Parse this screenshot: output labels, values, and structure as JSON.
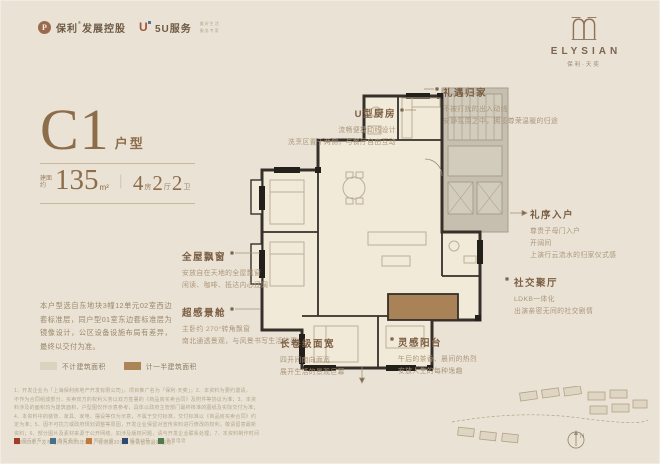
{
  "header": {
    "poly_brand": "保利",
    "poly_reg": "®",
    "poly_suffix": "发展控股",
    "service_brand": "5U服务",
    "service_note_1": "美好生活",
    "service_note_2": "服务专家",
    "project_name": "ELYSIAN",
    "project_sub": "保利·天奕"
  },
  "hero": {
    "code": "C1",
    "code_suffix": "户型",
    "area_label": "建面约",
    "area_value": "135",
    "area_unit": "m²",
    "divider": "｜",
    "room_1_num": "4",
    "room_1_unit": "房",
    "room_2_num": "2",
    "room_2_unit": "厅",
    "room_3_num": "2",
    "room_3_unit": "卫"
  },
  "annotations": {
    "u_kitchen": {
      "title": "U型厨房",
      "line1": "流畅便捷动线设计",
      "line2": "洗烹区置于两侧，与餐厅自由互动"
    },
    "homecoming": {
      "title": "礼遇归家",
      "line1": "不被打扰的出入动线",
      "line2": "安静氛围之中，拥揽尊荣温暖的归途"
    },
    "entry": {
      "title": "礼序入户",
      "line1": "尊贵子母门入户",
      "line2": "开阔间",
      "line3": "上演行云流水的归家仪式感"
    },
    "social": {
      "title": "社交聚厅",
      "line1": "LDKB一体化",
      "line2": "出演亲密无间的社交剧情"
    },
    "bay": {
      "title": "全屋飘窗",
      "line1": "安放自在天地的全屋飘窗",
      "line2": "闲读、咖啡、抵达内心辽阔"
    },
    "view": {
      "title": "超感景舱",
      "line1": "主卧约 270°转角飘窗",
      "line2": "南北通透景观，与风景书写生活故事"
    },
    "width": {
      "title": "长卷级面宽",
      "line1": "四开间南向面宽",
      "line2": "展开生活的景观巨幕"
    },
    "balcony": {
      "title": "灵感阳台",
      "line1": "午后的茶香、晨间的热烈",
      "line2": "安放人生的每种逸趣"
    }
  },
  "description": {
    "text": "本户型选自东地块3幢12单元02室西边套标准层，同户型01室东边套标准层为镜像设计，公区设备设施布局有差异，最终以交付为准。"
  },
  "legend": {
    "items": [
      {
        "label": "不计建筑面积",
        "color": "#dbd2bf"
      },
      {
        "label": "计一半建筑面积",
        "color": "#ab8457"
      }
    ]
  },
  "disclaimer": {
    "lines": [
      "1、开发企业为「上海保利房地产开发有限公司」，项目推广名为「保利·天奕」；2、本资料为要约邀请，",
      "不作为合同组成部分，买卖双方的权利义务以双方签署的《商品房买卖合同》及附件等协议为准；3、本资",
      "料涉及的面积均为建筑面积，户型图仅作示意参考，具体以政府主管部门最终核准的图纸及实际交付为准；",
      "4、本资料中的装饰、家具、家电、摆设等仅为示意，不属于交付标准，交付标准以《商品房买卖合同》约",
      "定为准；5、因不可抗力或政府规划调整等原因，开发企业保留对宣传资料进行修改的权利，敬请留意最新",
      "资料；6、部分图片及素材来源于公开网络，如涉及版权问题，请与开发企业联系处理；7、本资料制作时间",
      "为2023年，发布时间为2023年6月，有效期30天，敬请留意最新信息。"
    ]
  },
  "cert_row": {
    "items": [
      {
        "label": "官方发布",
        "color": "#a23d2c"
      },
      {
        "label": "备案查询",
        "color": "#44708a"
      },
      {
        "label": "网签公示",
        "color": "#c0793a"
      },
      {
        "label": "信息公开",
        "color": "#2f4a70"
      },
      {
        "label": "监督电话",
        "color": "#4f7a4b"
      }
    ]
  },
  "compass": {
    "label": "N"
  }
}
